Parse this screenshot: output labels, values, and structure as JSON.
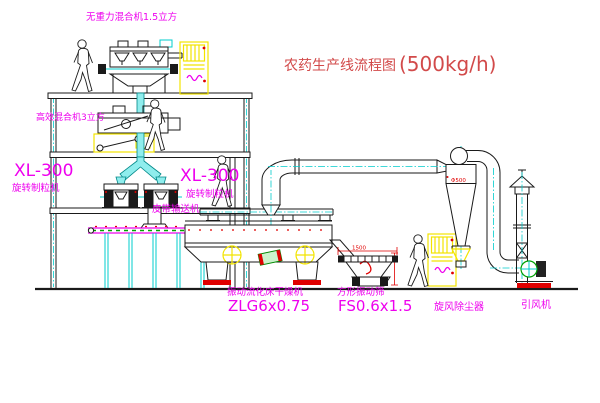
{
  "title": {
    "text": "农药生产线流程图",
    "capacity": "(500kg/h)"
  },
  "equipment": {
    "gravity_mixer": {
      "label": "无重力混合机1.5立方"
    },
    "high_efficiency_mixer": {
      "label": "高效混合机3立方"
    },
    "granulator": {
      "model": "XL-300",
      "name": "旋转制粒机"
    },
    "belt_conveyor": {
      "label": "皮带输送机"
    },
    "fluid_bed_dryer": {
      "name": "振动流化床干燥机",
      "model": "ZLG6x0.75"
    },
    "square_sieve": {
      "name": "方形振动筛",
      "model": "FS0.6x1.5",
      "dim_width": "1500"
    },
    "cyclone": {
      "name": "旋风除尘器",
      "dim": "Φ500"
    },
    "induced_draft_fan": {
      "name": "引风机"
    }
  },
  "colors": {
    "label_magenta": "#ee00ee",
    "title_red": "#d24a4a",
    "dimension_red": "#e00000",
    "cabinet_yellow": "#f2e400",
    "pipe_cyan": "#00cccc",
    "line_black": "#1a1a1a"
  }
}
